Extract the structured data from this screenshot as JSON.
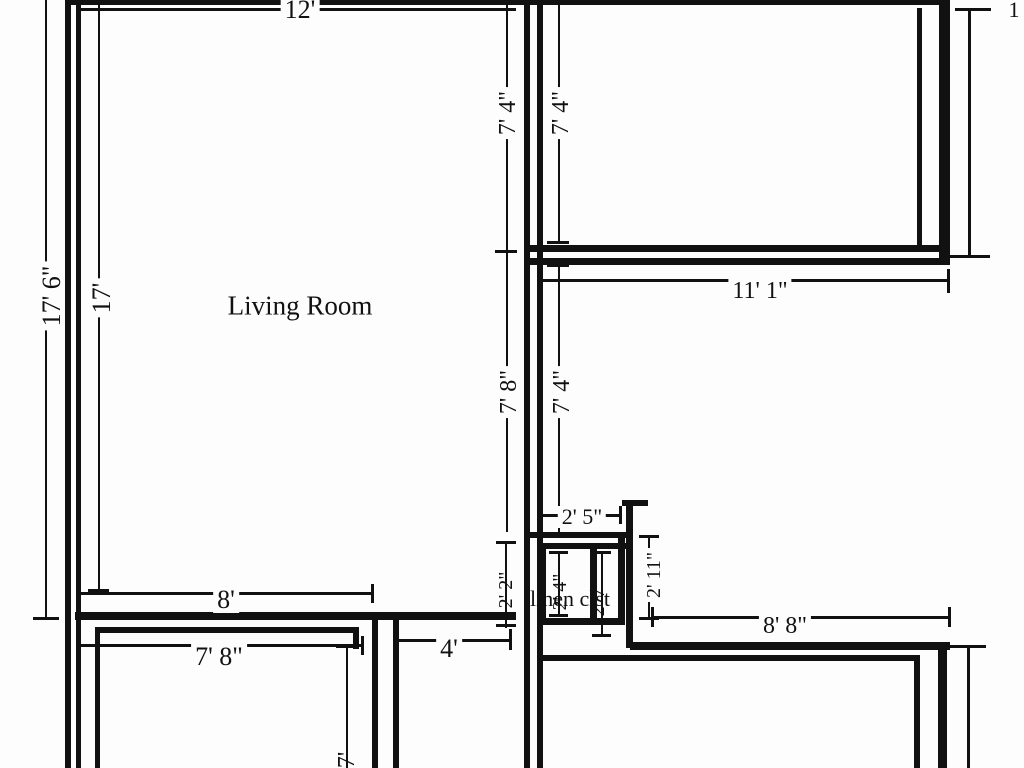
{
  "plan": {
    "type": "floor-plan",
    "ink_color": "#111111",
    "background_color": "#fdfdfd",
    "rooms": {
      "living_room": "Living Room",
      "linen_closet": "linen clst"
    },
    "dimensions": {
      "top_width": "12'",
      "left_outer_height": "17' 6\"",
      "left_inner_height": "17'",
      "upper_left_vertical": "7' 4\"",
      "upper_right_vertical": "7' 4\"",
      "mid_left_vertical": "7' 8\"",
      "mid_right_vertical": "7' 4\"",
      "top_right_room_width": "11' 1\"",
      "living_bottom_width": "8'",
      "bottom_left_room_width": "7' 8\"",
      "hall_opening": "4'",
      "closet_top_width": "2' 5\"",
      "closet_left_height": "2' 2\"",
      "closet_inner_left_height": "2' 4\"",
      "closet_inner_right_height": "2' 7\"",
      "closet_right_height": "2' 11\"",
      "bottom_right_room_width": "8' 8\"",
      "bottom_left_cutoff": "7'",
      "top_right_cutoff": "1"
    }
  }
}
